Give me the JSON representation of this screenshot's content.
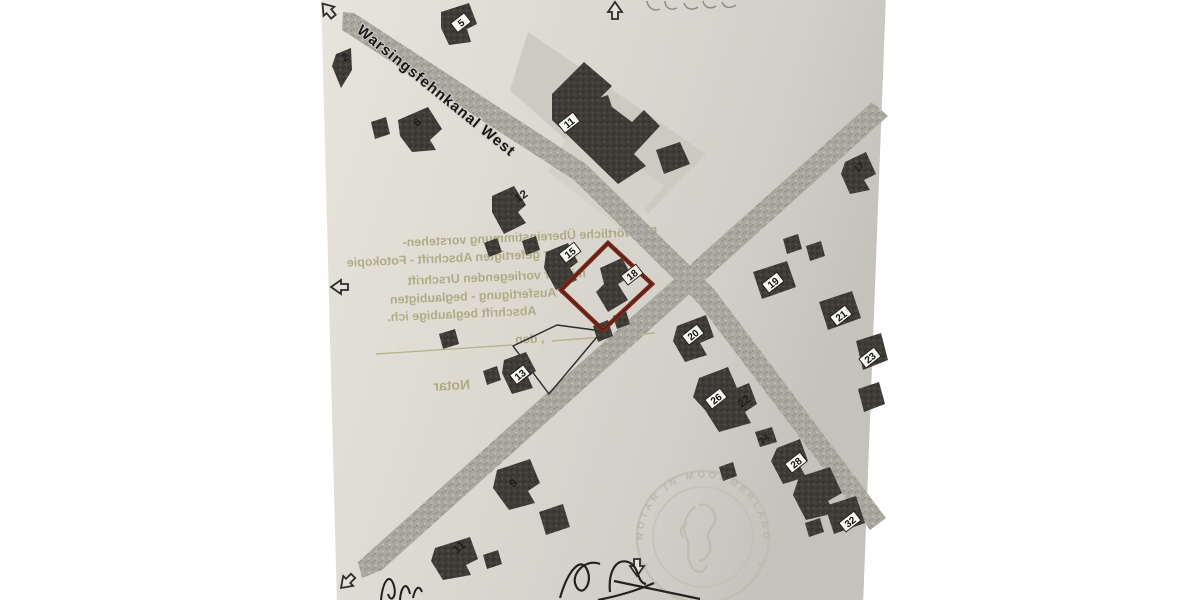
{
  "street": {
    "name": "Warsingsfehnkanal West"
  },
  "map": {
    "highlight_color": "#7a2a1a",
    "labels": [
      {
        "text": "2"
      },
      {
        "text": "5"
      },
      {
        "text": "6"
      },
      {
        "text": "11"
      },
      {
        "text": "12"
      },
      {
        "text": "15"
      },
      {
        "text": "18"
      },
      {
        "text": "17"
      },
      {
        "text": "19"
      },
      {
        "text": "21"
      },
      {
        "text": "23"
      },
      {
        "text": "20"
      },
      {
        "text": "26"
      },
      {
        "text": "22"
      },
      {
        "text": "24"
      },
      {
        "text": "28"
      },
      {
        "text": "32"
      },
      {
        "text": "13"
      },
      {
        "text": "9"
      },
      {
        "text": "11"
      }
    ]
  },
  "certification": {
    "line1": "Die wörtliche Übereinstimmung vorstehen-",
    "line2": "der gefertigten Abschrift - Fotokopie",
    "line3": "mit der vorliegenden Urschrift",
    "line4": "- Ausfertigung - beglaubigten",
    "line5": "Abschrift beglaubige ich.",
    "date_label": ", den",
    "signer_label": "Notar"
  },
  "seal": {
    "arc_text": "NOTAR IN MOORMERLAND"
  }
}
